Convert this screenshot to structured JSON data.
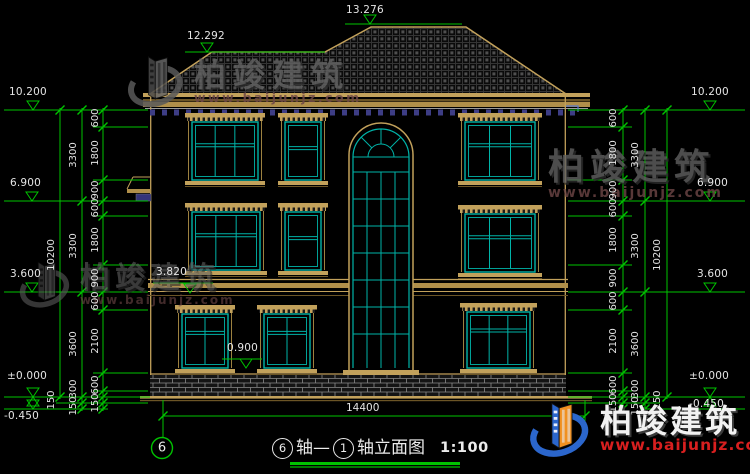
{
  "colors": {
    "dim_green": "#00c300",
    "line_tan": "#c2a15b",
    "window_cyan": "#00b3a8",
    "text_white": "#e4e4e4",
    "dentil_navy": "#3d3d85",
    "logo_blue": "#2b66cc",
    "logo_orange": "#f09020",
    "url_red": "#d81f1f"
  },
  "levels": {
    "left": [
      "10.200",
      "6.900",
      "3.600",
      "±0.000",
      "-0.450"
    ],
    "right": [
      "10.200",
      "6.900",
      "3.600",
      "±0.000",
      "-0.450"
    ],
    "roof": [
      "12.292",
      "13.276"
    ],
    "facade": [
      "3.820",
      "0.900"
    ]
  },
  "dims": {
    "left_inner": [
      "600",
      "1800",
      "900",
      "600",
      "1800",
      "900",
      "600",
      "2100",
      "600",
      "150"
    ],
    "left_mid": [
      "3300",
      "3300",
      "3600",
      "300",
      "150"
    ],
    "left_outer": [
      "10200",
      "150"
    ],
    "right_inner": [
      "600",
      "1800",
      "900",
      "600",
      "1800",
      "900",
      "600",
      "2100",
      "600",
      "150"
    ],
    "right_mid": [
      "3300",
      "3300",
      "3600",
      "300",
      "150"
    ],
    "right_outer": [
      "10200",
      "150"
    ],
    "bottom_total": "14400"
  },
  "axis": {
    "bubble": "6"
  },
  "title": {
    "axis_a": "6",
    "mid": "轴—",
    "axis_b": "1",
    "name": "轴立面图",
    "scale": "1:100"
  },
  "watermark": {
    "cn": "柏竣建筑",
    "url": "www.baijunjz.com"
  }
}
